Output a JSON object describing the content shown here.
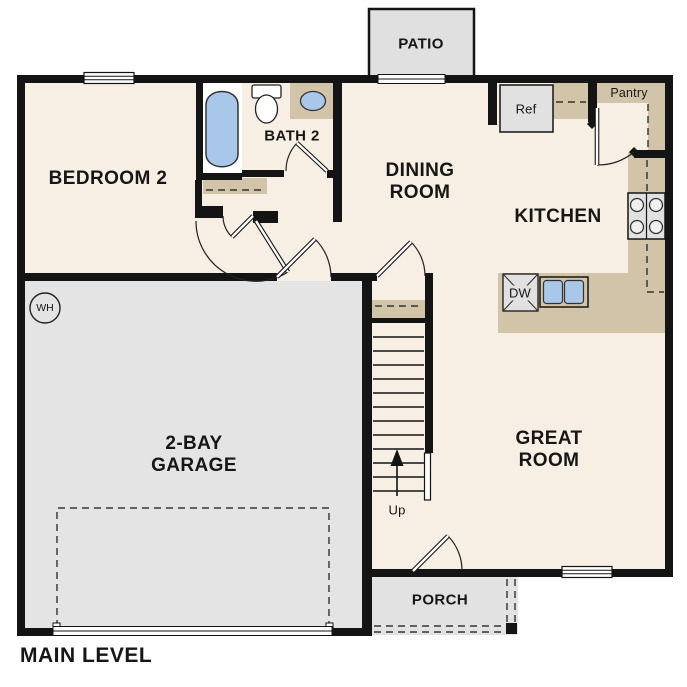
{
  "plan": {
    "title": "MAIN LEVEL",
    "rooms": {
      "bedroom2": "BEDROOM 2",
      "bath2": "BATH 2",
      "dining": "DINING\nROOM",
      "kitchen": "KITCHEN",
      "great_room": "GREAT\nROOM",
      "garage": "2-BAY\nGARAGE",
      "patio": "PATIO",
      "porch": "PORCH",
      "pantry": "Pantry"
    },
    "fixtures": {
      "refrigerator": "Ref",
      "dishwasher": "DW",
      "water_heater": "WH",
      "stairs_direction": "Up"
    },
    "colors": {
      "floor_cream": "#f7efe3",
      "floor_gray": "#e4e4e4",
      "counter_tan": "#d1c4a9",
      "fixture_blue": "#a9c7e9",
      "wall": "#141414",
      "background": "#ffffff"
    }
  }
}
